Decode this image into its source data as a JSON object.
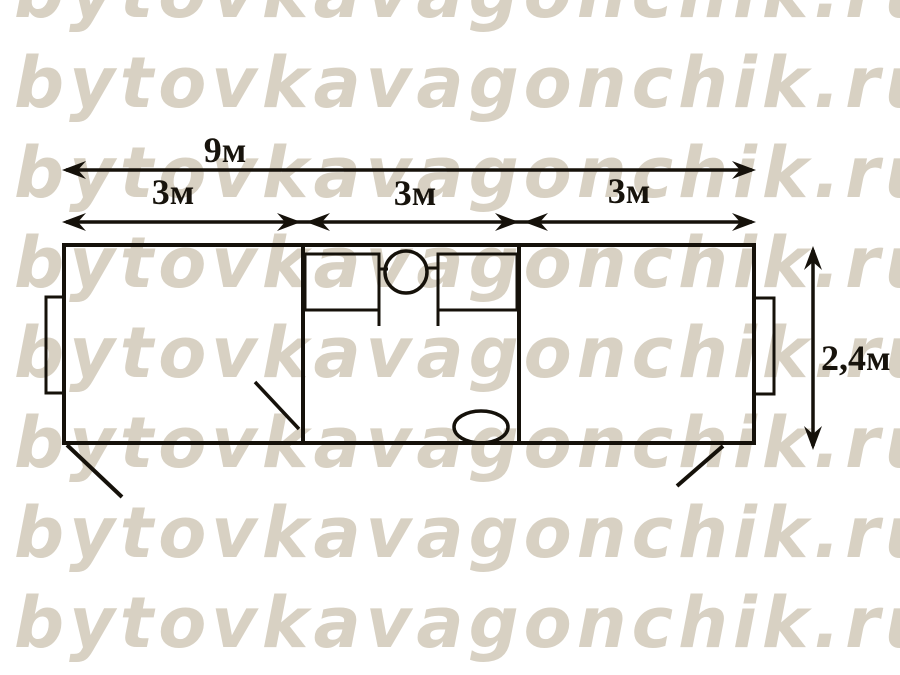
{
  "watermark": {
    "text": "bytovkavagonchik.ru",
    "color": "#d8d1c3",
    "rows": 8
  },
  "diagram": {
    "title": "cabin floor plan",
    "length_total_label": "9м",
    "section_labels": [
      "3м",
      "3м",
      "3м"
    ],
    "width_label": "2,4м",
    "line_color": "#15110a"
  }
}
